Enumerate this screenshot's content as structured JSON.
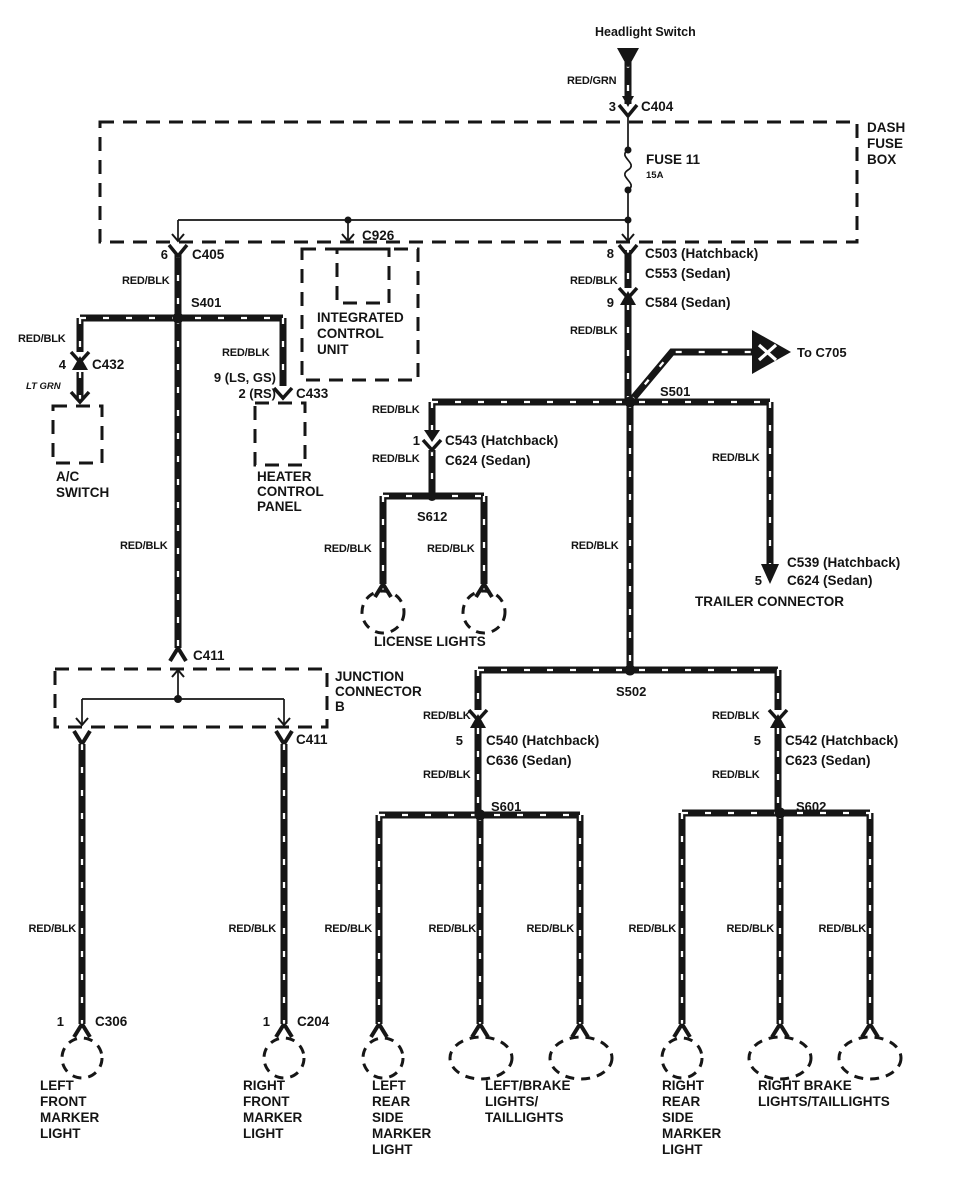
{
  "diagram": {
    "headlight_switch": "Headlight Switch",
    "to_c705": "To C705",
    "license_lights": "LICENSE LIGHTS",
    "trailer_connector": "TRAILER CONNECTOR",
    "dash_fuse_box": {
      "l1": "DASH",
      "l2": "FUSE",
      "l3": "BOX"
    },
    "fuse": {
      "name": "FUSE 11",
      "rating": "15A"
    },
    "icu": {
      "l1": "INTEGRATED",
      "l2": "CONTROL",
      "l3": "UNIT"
    },
    "ac_switch": {
      "l1": "A/C",
      "l2": "SWITCH"
    },
    "heater": {
      "l1": "HEATER",
      "l2": "CONTROL",
      "l3": "PANEL"
    },
    "junction": {
      "l1": "JUNCTION",
      "l2": "CONNECTOR",
      "l3": "B"
    },
    "wire_colors": {
      "red_grn": "RED/GRN",
      "red_blk": "RED/BLK",
      "lt_grn": "LT GRN"
    },
    "splices": {
      "s401": "S401",
      "s501": "S501",
      "s502": "S502",
      "s601": "S601",
      "s602": "S602",
      "s612": "S612"
    },
    "connectors": {
      "c404": {
        "pin": "3",
        "name": "C404"
      },
      "c405": {
        "pin": "6",
        "name": "C405"
      },
      "c926": {
        "name": "C926"
      },
      "c432": {
        "pin": "4",
        "name": "C432"
      },
      "c433": {
        "pin_a": "9 (LS, GS)",
        "pin_b": "2 (RS)",
        "name": "C433"
      },
      "c503": {
        "pin": "8",
        "name": "C503 (Hatchback)",
        "alt": "C553 (Sedan)"
      },
      "c584": {
        "pin": "9",
        "name": "C584 (Sedan)"
      },
      "c543": {
        "pin": "1",
        "name": "C543 (Hatchback)",
        "alt": "C624 (Sedan)"
      },
      "c539": {
        "pin": "5",
        "name": "C539 (Hatchback)",
        "alt": "C624 (Sedan)"
      },
      "c540": {
        "pin": "5",
        "name": "C540 (Hatchback)",
        "alt": "C636 (Sedan)"
      },
      "c542": {
        "pin": "5",
        "name": "C542 (Hatchback)",
        "alt": "C623 (Sedan)"
      },
      "c411_top": {
        "name": "C411"
      },
      "c411_bot": {
        "name": "C411"
      },
      "c306": {
        "pin": "1",
        "name": "C306"
      },
      "c204": {
        "pin": "1",
        "name": "C204"
      }
    },
    "lamps": {
      "left_front": {
        "l1": "LEFT",
        "l2": "FRONT",
        "l3": "MARKER",
        "l4": "LIGHT"
      },
      "right_front": {
        "l1": "RIGHT",
        "l2": "FRONT",
        "l3": "MARKER",
        "l4": "LIGHT"
      },
      "left_rear": {
        "l1": "LEFT",
        "l2": "REAR",
        "l3": "SIDE",
        "l4": "MARKER",
        "l5": "LIGHT"
      },
      "left_brake": {
        "l1": "LEFT/BRAKE",
        "l2": "LIGHTS/",
        "l3": "TAILLIGHTS"
      },
      "right_rear": {
        "l1": "RIGHT",
        "l2": "REAR",
        "l3": "SIDE",
        "l4": "MARKER",
        "l5": "LIGHT"
      },
      "right_brake": {
        "l1": "RIGHT BRAKE",
        "l2": "LIGHTS/TAILLIGHTS"
      }
    }
  }
}
